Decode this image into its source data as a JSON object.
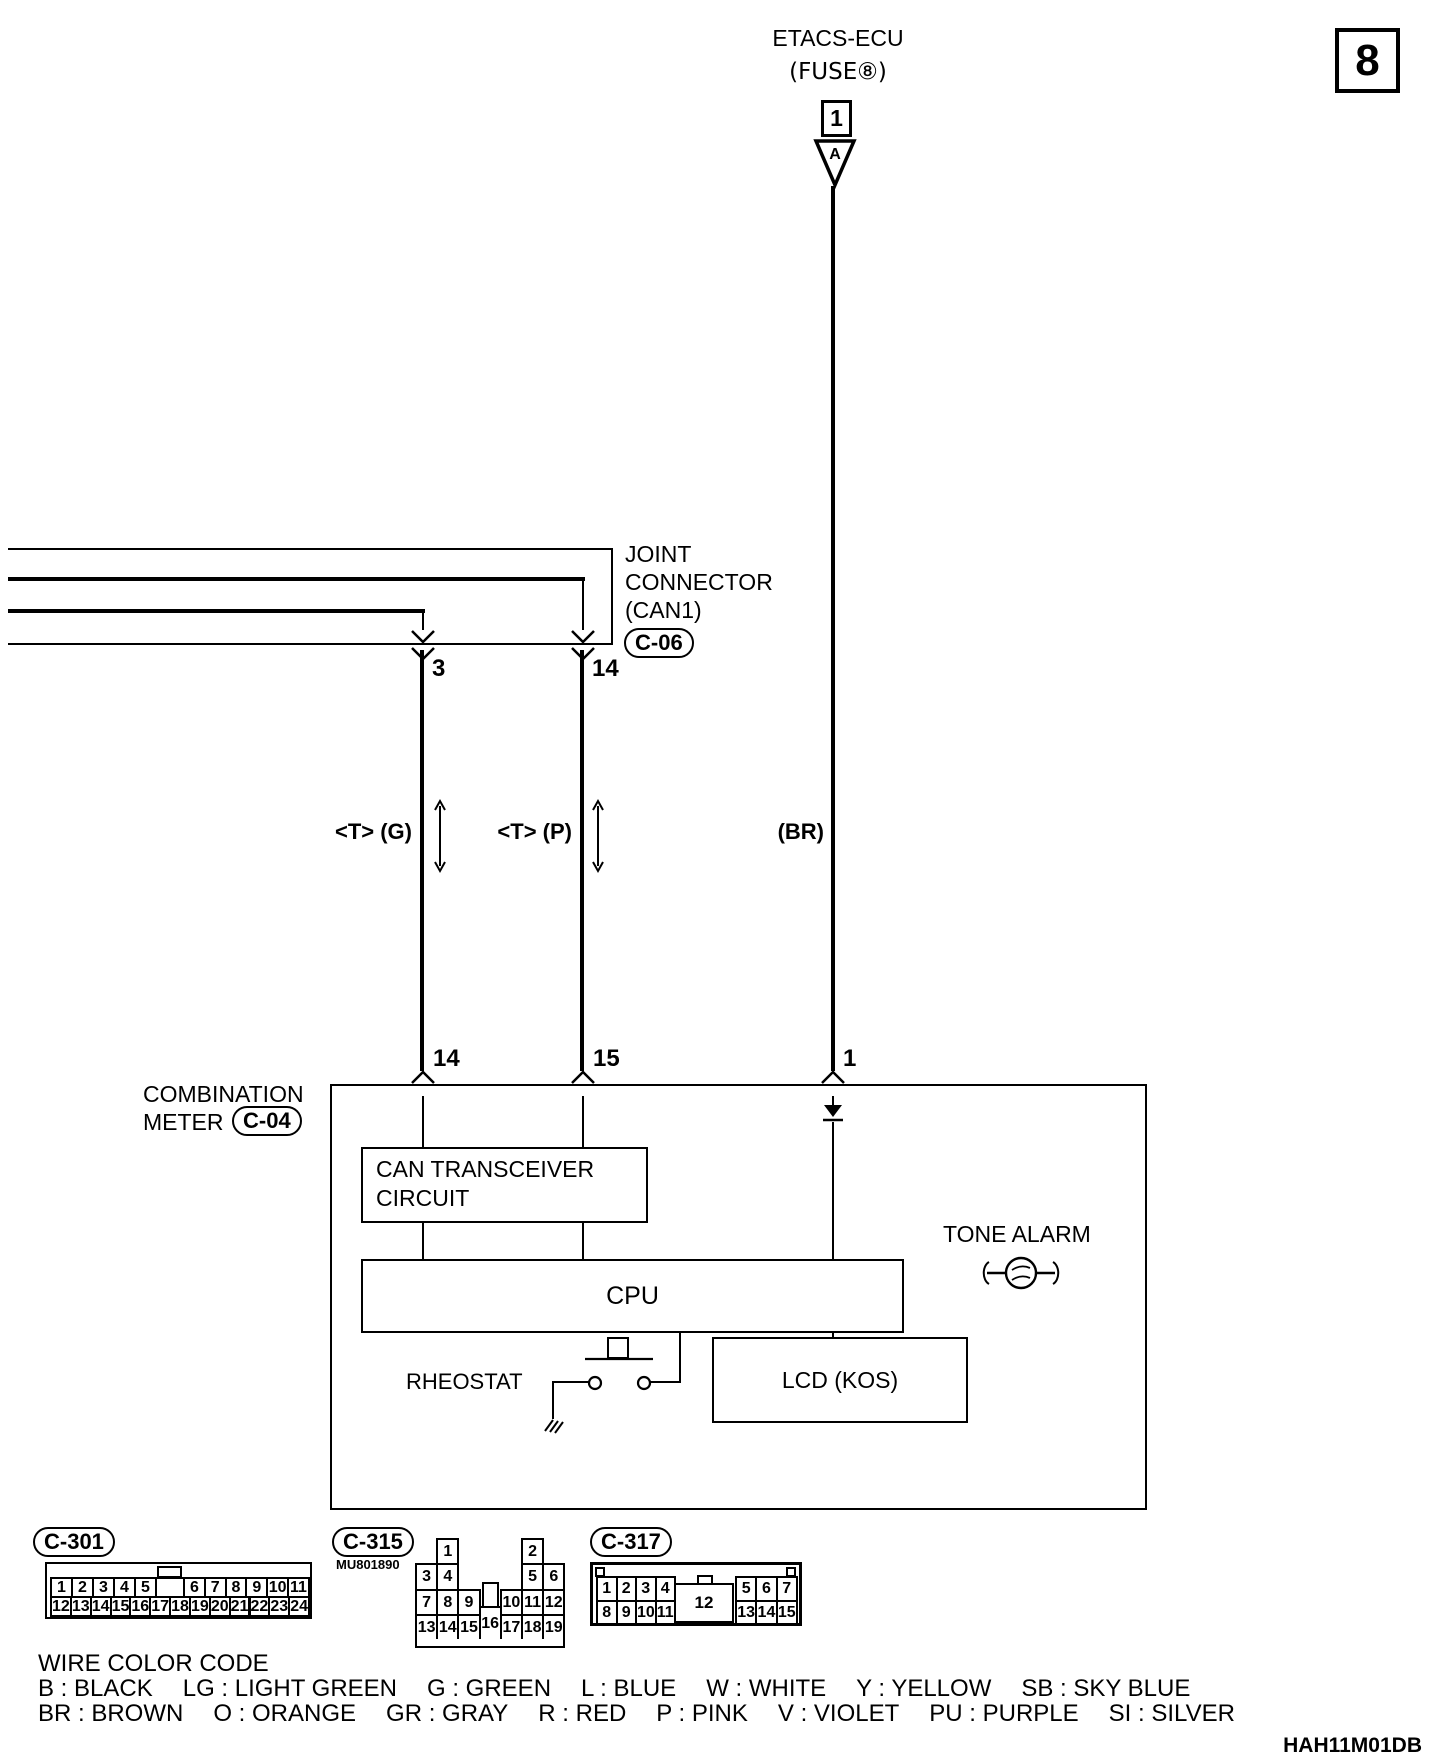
{
  "colors": {
    "ink": "#000000",
    "paper": "#ffffff"
  },
  "page": {
    "sheet_number": "8",
    "doc_code": "HAH11M01DB"
  },
  "top": {
    "title": "ETACS-ECU",
    "subtitle": "(FUSE⑧)",
    "pin": "1",
    "arrow_label": "A"
  },
  "joint_connector": {
    "line1": "JOINT",
    "line2": "CONNECTOR",
    "line3": "(CAN1)",
    "code": "C-06",
    "pin_left": "3",
    "pin_right": "14"
  },
  "wire_labels": {
    "can_g": "<T> (G)",
    "can_p": "<T> (P)",
    "power": "(BR)"
  },
  "combination_meter": {
    "name_line1": "COMBINATION",
    "name_line2": "METER",
    "code": "C-04",
    "pin_can_g": "14",
    "pin_can_p": "15",
    "pin_power": "1",
    "can_transceiver_line1": "CAN TRANSCEIVER",
    "can_transceiver_line2": "CIRCUIT",
    "cpu": "CPU",
    "rheostat": "RHEOSTAT",
    "lcd": "LCD (KOS)",
    "tone_alarm": "TONE ALARM"
  },
  "connectors": {
    "c301": {
      "code": "C-301",
      "top_left_pins": [
        "1",
        "2",
        "3",
        "4",
        "5"
      ],
      "top_right_pins": [
        "6",
        "7",
        "8",
        "9",
        "10",
        "11"
      ],
      "bottom_pins": [
        "12",
        "13",
        "14",
        "15",
        "16",
        "17",
        "18",
        "19",
        "20",
        "21",
        "22",
        "23",
        "24"
      ]
    },
    "c315": {
      "code": "C-315",
      "part_no": "MU801890",
      "tall_pin": "16",
      "cells": [
        {
          "n": "1",
          "col": 1,
          "row": 0
        },
        {
          "n": "2",
          "col": 5,
          "row": 0
        },
        {
          "n": "3",
          "col": 0,
          "row": 1
        },
        {
          "n": "4",
          "col": 1,
          "row": 1
        },
        {
          "n": "5",
          "col": 5,
          "row": 1
        },
        {
          "n": "6",
          "col": 6,
          "row": 1
        },
        {
          "n": "7",
          "col": 0,
          "row": 2
        },
        {
          "n": "8",
          "col": 1,
          "row": 2
        },
        {
          "n": "9",
          "col": 2,
          "row": 2
        },
        {
          "n": "10",
          "col": 4,
          "row": 2
        },
        {
          "n": "11",
          "col": 5,
          "row": 2
        },
        {
          "n": "12",
          "col": 6,
          "row": 2
        },
        {
          "n": "13",
          "col": 0,
          "row": 3
        },
        {
          "n": "14",
          "col": 1,
          "row": 3
        },
        {
          "n": "15",
          "col": 2,
          "row": 3
        },
        {
          "n": "17",
          "col": 4,
          "row": 3
        },
        {
          "n": "18",
          "col": 5,
          "row": 3
        },
        {
          "n": "19",
          "col": 6,
          "row": 3
        }
      ]
    },
    "c317": {
      "code": "C-317",
      "center_pin": "12",
      "top_left": [
        "1",
        "2",
        "3",
        "4"
      ],
      "top_right": [
        "5",
        "6",
        "7"
      ],
      "bottom_left": [
        "8",
        "9",
        "10",
        "11"
      ],
      "bottom_right": [
        "13",
        "14",
        "15"
      ]
    }
  },
  "wire_color_code": {
    "title": "WIRE COLOR CODE",
    "line1": [
      [
        "B",
        "BLACK"
      ],
      [
        "LG",
        "LIGHT GREEN"
      ],
      [
        "G",
        "GREEN"
      ],
      [
        "L",
        "BLUE"
      ],
      [
        "W",
        "WHITE"
      ],
      [
        "Y",
        "YELLOW"
      ],
      [
        "SB",
        "SKY BLUE"
      ]
    ],
    "line2": [
      [
        "BR",
        "BROWN"
      ],
      [
        "O",
        "ORANGE"
      ],
      [
        "GR",
        "GRAY"
      ],
      [
        "R",
        "RED"
      ],
      [
        "P",
        "PINK"
      ],
      [
        "V",
        "VIOLET"
      ],
      [
        "PU",
        "PURPLE"
      ],
      [
        "SI",
        "SILVER"
      ]
    ]
  }
}
